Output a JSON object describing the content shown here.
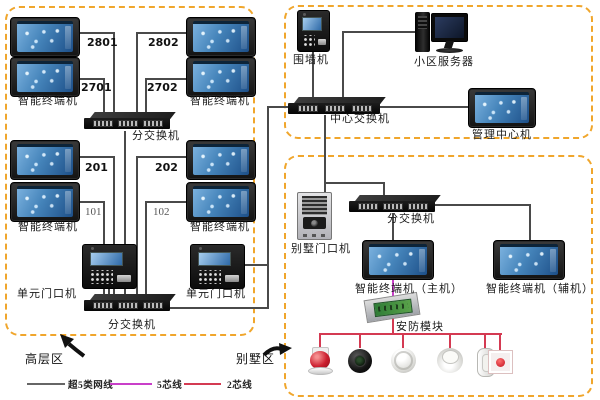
{
  "zones": {
    "highrise_label": "高层区",
    "villa_label": "别墅区"
  },
  "labels": {
    "terminal": "智能终端机",
    "sub_switch": "分交换机",
    "unit_door": "单元门口机",
    "wall_machine": "围墙机",
    "server": "小区服务器",
    "center_switch": "中心交换机",
    "management": "管理中心机",
    "villa_door": "别墅门口机",
    "terminal_main": "智能终端机（主机）",
    "terminal_aux": "智能终端机（辅机）",
    "security_module": "安防模块"
  },
  "room_numbers": {
    "n2801": "2801",
    "n2802": "2802",
    "n2701": "2701",
    "n2702": "2702",
    "n201": "201",
    "n202": "202",
    "n101": "101",
    "n102": "102"
  },
  "legend": {
    "cat5e": {
      "label": "超5类网线",
      "color": "#666666"
    },
    "core5": {
      "label": "5芯线",
      "color": "#c93fc9"
    },
    "core2": {
      "label": "2芯线",
      "color": "#d43a52"
    }
  },
  "colors": {
    "zone_border": "#f0a62c",
    "wire": "#4a4a4a"
  },
  "icons": {
    "sensors": [
      "alarm-siren",
      "camera-lens",
      "smoke-detector",
      "heat-detector",
      "door-contact",
      "emergency-button"
    ]
  }
}
